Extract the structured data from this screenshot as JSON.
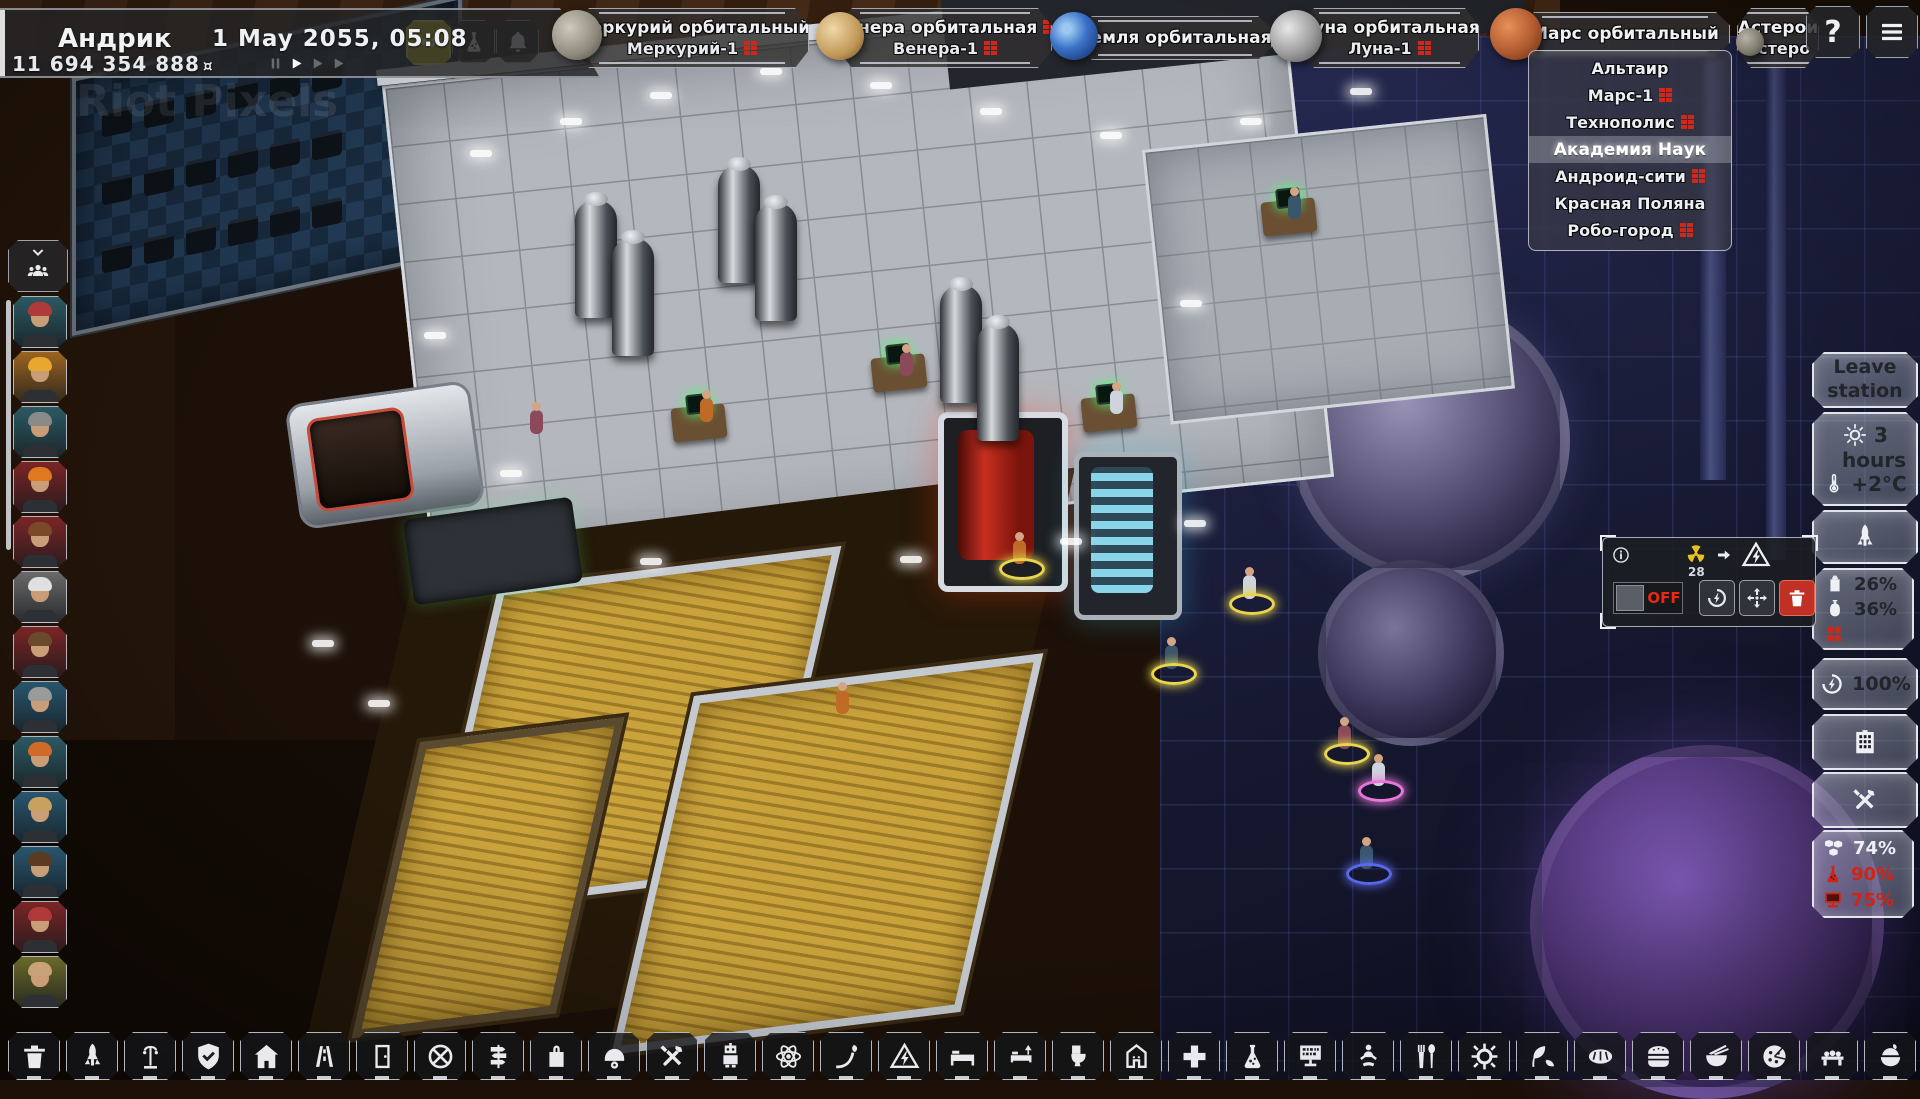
{
  "hud": {
    "player_name": "Андрик",
    "money": "11 694 354 888",
    "currency_symbol": "¤",
    "date": "1 May 2055, 05:08",
    "watermark": "Riot Pixels"
  },
  "playback": {
    "speeds": 3,
    "active_speed": 1
  },
  "station_tabs": [
    {
      "title": "Меркурий орбитальный",
      "subtitle": "Меркурий-1",
      "planet": "mercury",
      "title_warning": false,
      "subtitle_warning": true
    },
    {
      "title": "Венера орбитальная",
      "subtitle": "Венера-1",
      "planet": "venus",
      "title_warning": true,
      "subtitle_warning": true
    },
    {
      "title": "Земля орбитальная",
      "subtitle": "",
      "planet": "earth",
      "title_warning": false,
      "subtitle_warning": false
    },
    {
      "title": "Луна орбитальная",
      "subtitle": "Луна-1",
      "planet": "moon",
      "title_warning": false,
      "subtitle_warning": true
    },
    {
      "title": "Марс  орбитальный",
      "subtitle": "",
      "planet": "mars",
      "title_warning": false,
      "subtitle_warning": false
    },
    {
      "title": "Астерои",
      "subtitle": "Астеро",
      "planet": "asteroid",
      "title_warning": false,
      "subtitle_warning": false
    }
  ],
  "mars_dropdown": [
    {
      "label": "Альтаир",
      "warning": false,
      "selected": false
    },
    {
      "label": "Марс-1",
      "warning": true,
      "selected": false
    },
    {
      "label": "Технополис",
      "warning": true,
      "selected": false
    },
    {
      "label": "Академия Наук",
      "warning": false,
      "selected": true
    },
    {
      "label": "Андроид-сити",
      "warning": true,
      "selected": false
    },
    {
      "label": "Красная Поляна",
      "warning": false,
      "selected": false
    },
    {
      "label": "Робо-город",
      "warning": true,
      "selected": false
    }
  ],
  "right_panel": {
    "leave_station_label": "Leave station",
    "duration_value": "3",
    "duration_unit": "hours",
    "temperature": "+2°C",
    "fuel_percent": "26%",
    "oxygen_percent": "36%",
    "energy_percent": "100%",
    "comfort_percent": "74%",
    "science_percent": "90%",
    "tech_percent": "75%"
  },
  "machine_panel": {
    "radiation_count": "28",
    "power_toggle": "OFF"
  },
  "crew": {
    "portraits": [
      {
        "bg": "#2c5a63",
        "hair": "#b03a3a"
      },
      {
        "bg": "#9a6420",
        "hair": "#e8a830"
      },
      {
        "bg": "#2c5a63",
        "hair": "#8a8a8a"
      },
      {
        "bg": "#7a2525",
        "hair": "#e07820"
      },
      {
        "bg": "#7a2525",
        "hair": "#7a4a28"
      },
      {
        "bg": "#6a6a6a",
        "hair": "#e0e0e0"
      },
      {
        "bg": "#7a2525",
        "hair": "#6a4a2a"
      },
      {
        "bg": "#28566e",
        "hair": "#9a9a9a"
      },
      {
        "bg": "#2c5a63",
        "hair": "#d06a28"
      },
      {
        "bg": "#28566e",
        "hair": "#c8a060"
      },
      {
        "bg": "#28566e",
        "hair": "#5a3a20"
      },
      {
        "bg": "#7a2525",
        "hair": "#b03a3a"
      },
      {
        "bg": "#6a6a2a",
        "hair": "#caa27a"
      }
    ]
  },
  "toolbar": [
    {
      "icon": "trash"
    },
    {
      "icon": "rocket"
    },
    {
      "icon": "streetlamp"
    },
    {
      "icon": "shield"
    },
    {
      "icon": "home"
    },
    {
      "icon": "road"
    },
    {
      "icon": "door"
    },
    {
      "icon": "airlock"
    },
    {
      "icon": "signpost"
    },
    {
      "icon": "bag"
    },
    {
      "icon": "helmet"
    },
    {
      "icon": "tools"
    },
    {
      "icon": "robot"
    },
    {
      "icon": "atom"
    },
    {
      "icon": "sprout"
    },
    {
      "icon": "hazard"
    },
    {
      "icon": "bed"
    },
    {
      "icon": "bedlamp"
    },
    {
      "icon": "toilet"
    },
    {
      "icon": "shower"
    },
    {
      "icon": "medical"
    },
    {
      "icon": "flask"
    },
    {
      "icon": "display"
    },
    {
      "icon": "meditation"
    },
    {
      "icon": "cutlery"
    },
    {
      "icon": "gear"
    },
    {
      "icon": "leaves"
    },
    {
      "icon": "bread"
    },
    {
      "icon": "burger"
    },
    {
      "icon": "noodles"
    },
    {
      "icon": "pizza"
    },
    {
      "icon": "sushi"
    },
    {
      "icon": "rice"
    }
  ],
  "scene": {
    "tanks": [
      [
        575,
        200
      ],
      [
        612,
        238
      ],
      [
        718,
        165
      ],
      [
        755,
        203
      ],
      [
        940,
        285
      ],
      [
        977,
        323
      ]
    ],
    "characters": [
      [
        1243,
        575,
        "#e8d44d"
      ],
      [
        1165,
        645,
        "#e8d44d"
      ],
      [
        1013,
        540,
        "#e8d44d"
      ],
      [
        1338,
        725,
        "#e8d44d"
      ],
      [
        1372,
        762,
        "#e878d8"
      ],
      [
        1360,
        845,
        "#5868e8"
      ],
      [
        700,
        398,
        ""
      ],
      [
        900,
        352,
        ""
      ],
      [
        1110,
        390,
        ""
      ],
      [
        1288,
        195,
        ""
      ],
      [
        836,
        690,
        ""
      ],
      [
        530,
        410,
        ""
      ]
    ],
    "lights": [
      [
        470,
        150
      ],
      [
        560,
        118
      ],
      [
        650,
        92
      ],
      [
        760,
        68
      ],
      [
        870,
        82
      ],
      [
        980,
        108
      ],
      [
        1100,
        132
      ],
      [
        424,
        332
      ],
      [
        500,
        470
      ],
      [
        640,
        558
      ],
      [
        900,
        556
      ],
      [
        1060,
        538
      ],
      [
        1240,
        118
      ],
      [
        1350,
        88
      ],
      [
        312,
        640
      ],
      [
        368,
        700
      ],
      [
        1180,
        300
      ],
      [
        1184,
        520
      ]
    ]
  }
}
